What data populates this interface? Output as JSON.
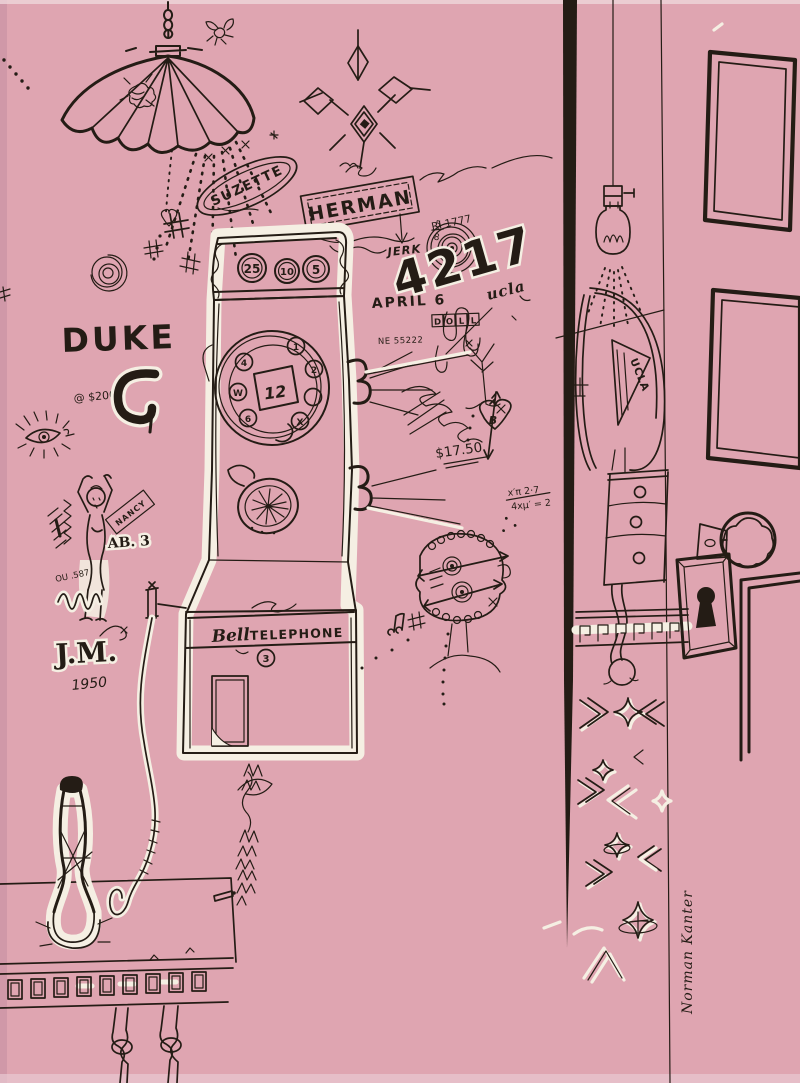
{
  "artwork": {
    "title": "graffiti wall with pay telephone",
    "background_color": "#dfa5b1",
    "ink_color": "#241c15",
    "highlight_color": "#f5efe3",
    "signature": "Norman Kanter",
    "graffiti": {
      "suzette": "SUZETTE",
      "herman": "HERMAN",
      "ri_number": "RI 1777",
      "jerk": "JERK",
      "big_number": "4217",
      "fraction_top": "5",
      "fraction_bottom": "8",
      "april": "APRIL 6",
      "doll_letters": [
        "D",
        "O",
        "L",
        "L"
      ],
      "ne_number": "NE 55222",
      "ucla_script": "ucla",
      "duke": "DUKE",
      "price_tag": "@ $200",
      "nancy": "NANCY",
      "ab_3": "AB. 3",
      "ou_number": "OU .587",
      "initials": "J.M.",
      "year": "1950",
      "price": "$17.50",
      "heart_initial": "B",
      "formula_top": "x′π 2·7",
      "formula_bottom": "4xμ′ = 2"
    },
    "phone": {
      "coin_slots": [
        "25",
        "10",
        "5"
      ],
      "dial_center": "12",
      "dial_holes": [
        "1",
        "2",
        "4",
        "W",
        "6",
        "X"
      ],
      "brand_script": "Bell",
      "brand_caps": "TELEPHONE",
      "door_number": "3"
    },
    "pennant_label": "UCLA"
  }
}
